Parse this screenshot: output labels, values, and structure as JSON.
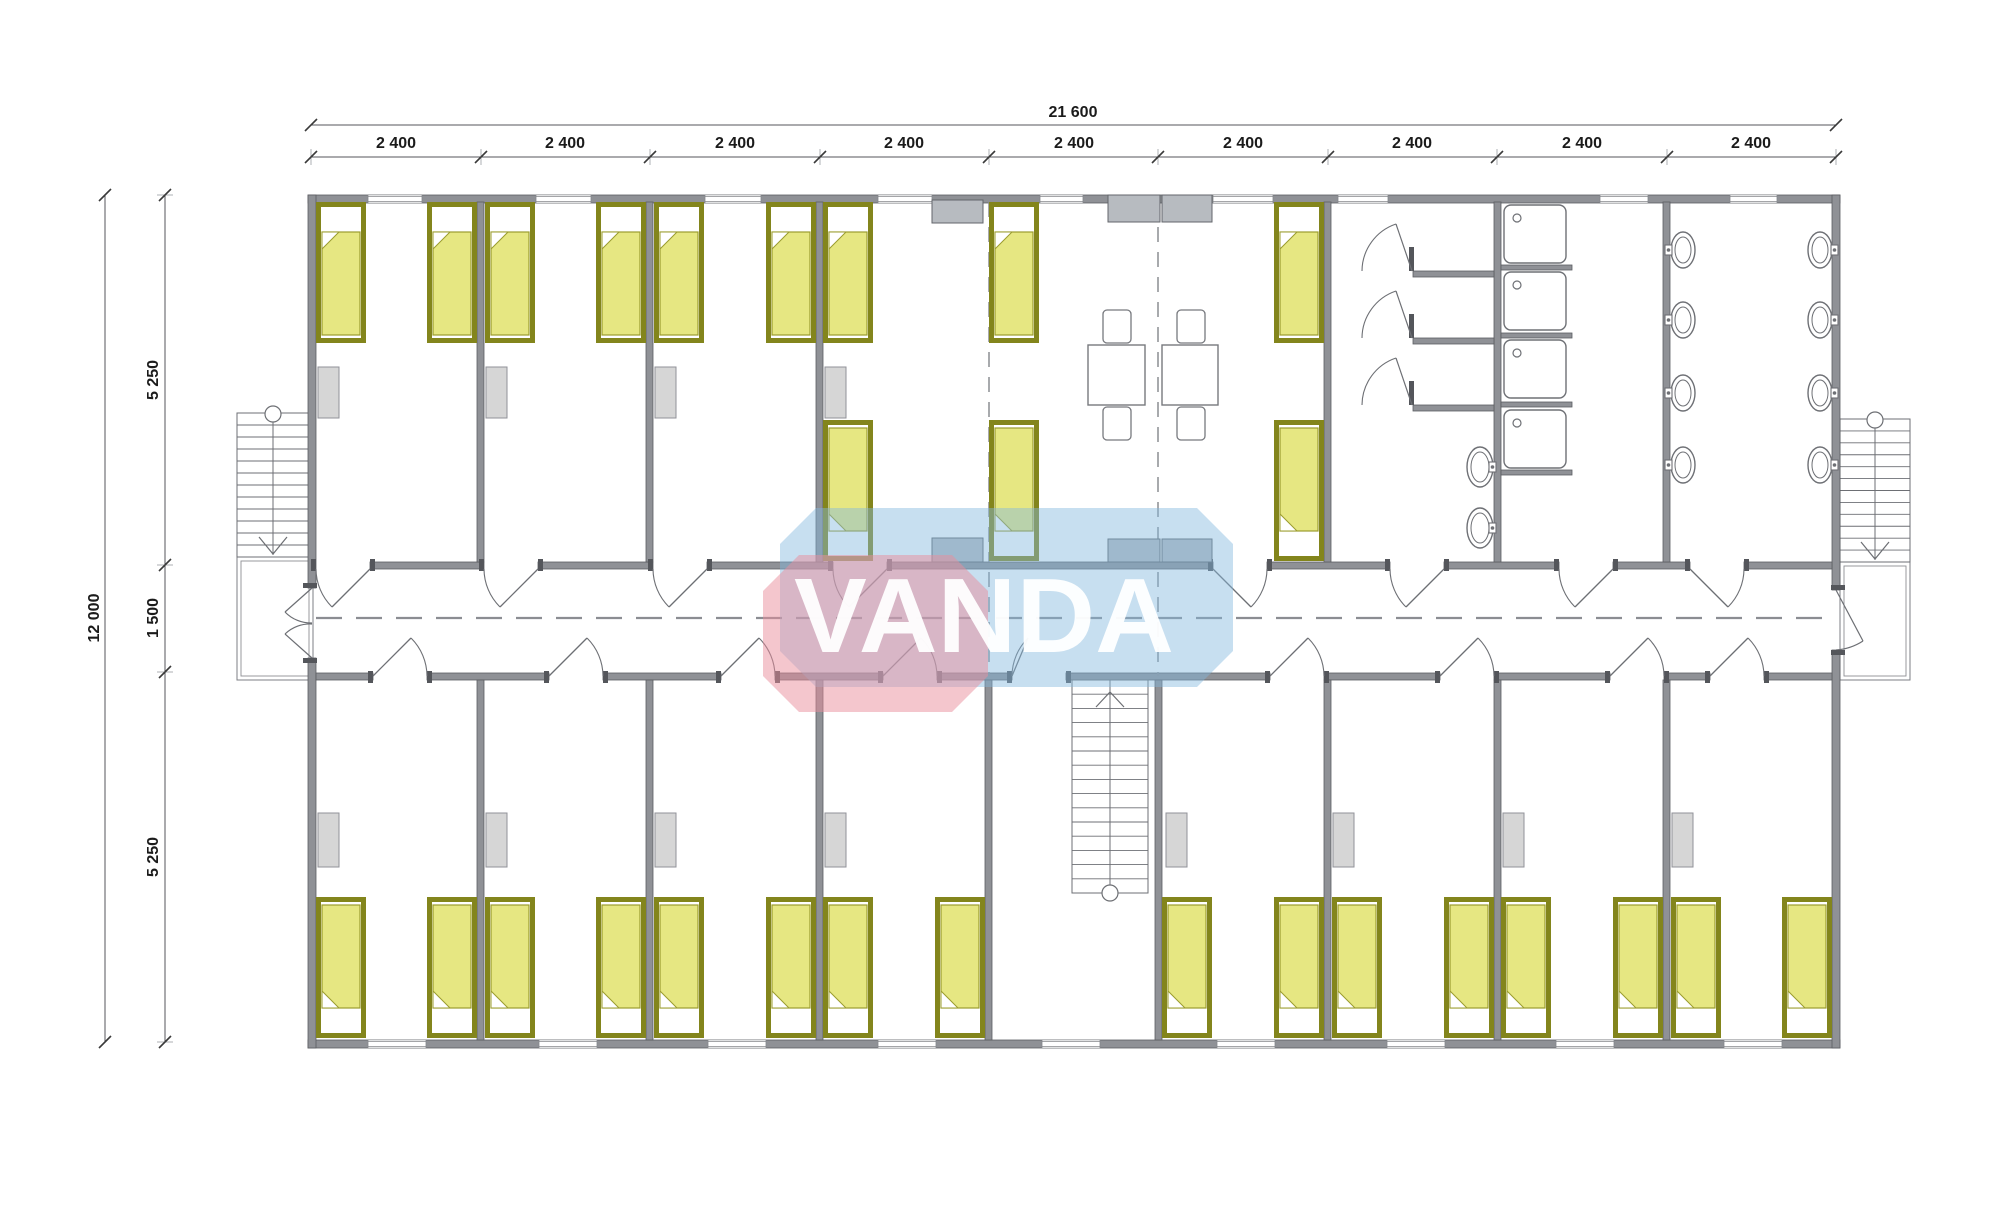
{
  "title": "VANDA modular dormitory floor plan",
  "dimensions": {
    "total_width_label": "21 600",
    "bay_label": "2 400",
    "bay_count": 9,
    "total_height_label": "12 000",
    "height_segment_labels": [
      "5 250",
      "1 500",
      "5 250"
    ]
  },
  "logo": {
    "text": "VANDA",
    "pink": "#ea8e9c",
    "blue": "#83b7de",
    "pink_opacity": 0.5,
    "blue_opacity": 0.45,
    "text_fill": "rgba(255,255,255,0.95)",
    "blue_pts": "816,508 1197,508 1233,544 1233,651 1197,687 816,687 780,651 780,544",
    "pink_pts": "799,555 952,555 988,591 988,676 952,712 799,712 763,676 763,591",
    "tx": 984,
    "ty": 652,
    "size": 106,
    "text_length": 380
  },
  "colors": {
    "wall": "#8f9196",
    "wall_stroke": "#5b5d62",
    "jamb": "#54565b",
    "line": "#6d6f74",
    "thin": "#9a9ca1",
    "dim_line": "#54565b",
    "tick": "#3a3a3a",
    "bed_frame": "#83851c",
    "bed_fill": "#ffffff",
    "blanket": "#e6e782",
    "blanket_line": "#9b9c2e",
    "furn_light": "#d6d6d6",
    "furn_light_stroke": "#909298",
    "counter": "#b7bbc0",
    "counter_stroke": "#63666b",
    "fixture": "#6e7075",
    "dash": "#8b8d92",
    "window_line": "#85878c"
  },
  "plan": {
    "canvas": {
      "w": 2000,
      "h": 1219
    },
    "walls": [
      [
        308,
        195,
        1532,
        8
      ],
      [
        308,
        1040,
        1532,
        8
      ],
      [
        308,
        195,
        8,
        393
      ],
      [
        308,
        658,
        8,
        390
      ],
      [
        1832,
        195,
        8,
        395
      ],
      [
        1832,
        650,
        8,
        398
      ],
      [
        370,
        562,
        114,
        7
      ],
      [
        538,
        562,
        115,
        7
      ],
      [
        707,
        562,
        126,
        7
      ],
      [
        887,
        562,
        326,
        7
      ],
      [
        1267,
        562,
        123,
        7
      ],
      [
        1444,
        562,
        115,
        7
      ],
      [
        1613,
        562,
        77,
        7
      ],
      [
        1744,
        562,
        88,
        7
      ],
      [
        316,
        673,
        57,
        7
      ],
      [
        427,
        673,
        122,
        7
      ],
      [
        603,
        673,
        118,
        7
      ],
      [
        775,
        673,
        108,
        7
      ],
      [
        937,
        673,
        75,
        7
      ],
      [
        1066,
        673,
        204,
        7
      ],
      [
        1324,
        673,
        116,
        7
      ],
      [
        1494,
        673,
        116,
        7
      ],
      [
        1664,
        673,
        46,
        7
      ],
      [
        1764,
        673,
        68,
        7
      ],
      [
        477,
        202,
        7,
        360
      ],
      [
        646,
        202,
        7,
        360
      ],
      [
        816,
        202,
        7,
        360
      ],
      [
        1324,
        202,
        7,
        360
      ],
      [
        1494,
        202,
        7,
        360
      ],
      [
        1663,
        202,
        7,
        360
      ],
      [
        477,
        680,
        7,
        360
      ],
      [
        646,
        680,
        7,
        360
      ],
      [
        816,
        680,
        7,
        360
      ],
      [
        985,
        680,
        7,
        360
      ],
      [
        1155,
        680,
        7,
        360
      ],
      [
        1324,
        680,
        7,
        360
      ],
      [
        1494,
        680,
        7,
        360
      ],
      [
        1663,
        680,
        7,
        360
      ],
      [
        1413,
        271,
        81,
        6
      ],
      [
        1413,
        338,
        81,
        6
      ],
      [
        1413,
        405,
        81,
        6
      ],
      [
        1501,
        265,
        71,
        5
      ],
      [
        1501,
        333,
        71,
        5
      ],
      [
        1501,
        402,
        71,
        5
      ],
      [
        1501,
        470,
        71,
        5
      ]
    ],
    "windows": {
      "top": [
        [
          368,
          54
        ],
        [
          536,
          55
        ],
        [
          705,
          56
        ],
        [
          878,
          54
        ],
        [
          1040,
          43
        ],
        [
          1213,
          60
        ],
        [
          1338,
          50
        ],
        [
          1600,
          48
        ],
        [
          1730,
          47
        ]
      ],
      "bottom": [
        [
          368,
          58
        ],
        [
          539,
          58
        ],
        [
          708,
          58
        ],
        [
          878,
          58
        ],
        [
          1042,
          58
        ],
        [
          1217,
          58
        ],
        [
          1387,
          58
        ],
        [
          1556,
          58
        ],
        [
          1724,
          58
        ]
      ]
    },
    "doors": {
      "upper": [
        [
          316,
          54,
          "r"
        ],
        [
          484,
          54,
          "r"
        ],
        [
          653,
          54,
          "r"
        ],
        [
          833,
          54,
          "r"
        ],
        [
          1213,
          54,
          "l"
        ],
        [
          1390,
          54,
          "r"
        ],
        [
          1559,
          54,
          "r"
        ],
        [
          1690,
          54,
          "l"
        ]
      ],
      "lower": [
        [
          373,
          54,
          "l"
        ],
        [
          549,
          54,
          "l"
        ],
        [
          721,
          54,
          "l"
        ],
        [
          883,
          54,
          "l"
        ],
        [
          1012,
          54,
          "r"
        ],
        [
          1270,
          54,
          "l"
        ],
        [
          1440,
          54,
          "l"
        ],
        [
          1610,
          54,
          "l"
        ],
        [
          1710,
          54,
          "l"
        ]
      ],
      "end_paths": [
        "M312,588 L285,612",
        "M285,612 A36,36 0 0 0 312,623",
        "M312,658 L285,634",
        "M285,634 A36,36 0 0 1 312,624",
        "M1836,590 L1863,641",
        "M1836,650 A57,57 0 0 0 1863,641"
      ],
      "end_jambs": [
        [
          303,
          583,
          14,
          5
        ],
        [
          303,
          658,
          14,
          5
        ],
        [
          1831,
          585,
          14,
          5
        ],
        [
          1831,
          650,
          14,
          5
        ]
      ]
    },
    "dashes": [
      [
        316,
        618,
        1832,
        618,
        "26 14",
        2.2
      ],
      [
        989,
        202,
        989,
        562,
        "15 10",
        1.5
      ],
      [
        989,
        572,
        989,
        676,
        "15 10",
        1.5
      ],
      [
        1158,
        202,
        1158,
        562,
        "15 10",
        1.5
      ],
      [
        1158,
        572,
        1158,
        676,
        "15 10",
        1.5
      ]
    ],
    "beds": {
      "w": 50,
      "h": 141,
      "n": [
        [
          316,
          202
        ],
        [
          427,
          202
        ],
        [
          485,
          202
        ],
        [
          596,
          202
        ],
        [
          654,
          202
        ],
        [
          766,
          202
        ],
        [
          823,
          202
        ],
        [
          989,
          202
        ],
        [
          1274,
          202
        ]
      ],
      "s": [
        [
          823,
          420
        ],
        [
          989,
          420
        ],
        [
          1274,
          420
        ],
        [
          316,
          897
        ],
        [
          427,
          897
        ],
        [
          485,
          897
        ],
        [
          596,
          897
        ],
        [
          654,
          897
        ],
        [
          766,
          897
        ],
        [
          823,
          897
        ],
        [
          935,
          897
        ],
        [
          1162,
          897
        ],
        [
          1274,
          897
        ],
        [
          1332,
          897
        ],
        [
          1444,
          897
        ],
        [
          1501,
          897
        ],
        [
          1613,
          897
        ],
        [
          1671,
          897
        ],
        [
          1782,
          897
        ]
      ]
    },
    "wardrobes": [
      [
        318,
        367,
        21,
        51
      ],
      [
        486,
        367,
        21,
        51
      ],
      [
        655,
        367,
        21,
        51
      ],
      [
        825,
        367,
        21,
        51
      ],
      [
        318,
        813,
        21,
        54
      ],
      [
        486,
        813,
        21,
        54
      ],
      [
        655,
        813,
        21,
        54
      ],
      [
        825,
        813,
        21,
        54
      ],
      [
        1166,
        813,
        21,
        54
      ],
      [
        1333,
        813,
        21,
        54
      ],
      [
        1503,
        813,
        21,
        54
      ],
      [
        1672,
        813,
        21,
        54
      ]
    ],
    "counters": [
      [
        932,
        200,
        51,
        23
      ],
      [
        1108,
        195,
        52,
        27
      ],
      [
        1162,
        195,
        50,
        27
      ],
      [
        932,
        538,
        51,
        24
      ],
      [
        1108,
        539,
        52,
        23
      ],
      [
        1162,
        539,
        50,
        23
      ]
    ],
    "tables": [
      [
        1088,
        345,
        57,
        60
      ],
      [
        1162,
        345,
        56,
        60
      ]
    ],
    "chairs": [
      [
        1103,
        310,
        28,
        33
      ],
      [
        1177,
        310,
        28,
        33
      ],
      [
        1103,
        407,
        28,
        33
      ],
      [
        1177,
        407,
        28,
        33
      ]
    ],
    "sinks": {
      "size": [
        62,
        58
      ],
      "pos": [
        [
          1504,
          205
        ],
        [
          1504,
          272
        ],
        [
          1504,
          340
        ],
        [
          1504,
          410
        ]
      ]
    },
    "wcs": [
      [
        1480,
        467
      ],
      [
        1480,
        528
      ]
    ],
    "basins": {
      "left": [
        [
          1683,
          250
        ],
        [
          1683,
          320
        ],
        [
          1683,
          393
        ],
        [
          1683,
          465
        ]
      ],
      "right": [
        [
          1820,
          250
        ],
        [
          1820,
          320
        ],
        [
          1820,
          393
        ],
        [
          1820,
          465
        ]
      ]
    },
    "cubicles": {
      "pivots": [
        [
          1412,
          271
        ],
        [
          1412,
          338
        ],
        [
          1412,
          405
        ]
      ],
      "stubs": [
        [
          1409,
          247,
          5,
          24
        ],
        [
          1409,
          314,
          5,
          24
        ],
        [
          1409,
          381,
          5,
          24
        ]
      ]
    },
    "stairs": {
      "ext": [
        {
          "x": 237,
          "y": 413,
          "w": 73,
          "h": 144,
          "cx": 273,
          "cy": 414,
          "treads": 12
        },
        {
          "x": 1840,
          "y": 419,
          "w": 70,
          "h": 143,
          "cx": 1875,
          "cy": 420,
          "treads": 12
        }
      ],
      "internal": {
        "x": 1072,
        "y": 680,
        "w": 76,
        "h": 213,
        "cx": 1110,
        "cy": 893,
        "treads": 15
      },
      "landings": [
        [
          237,
          557,
          76,
          123
        ],
        [
          1840,
          562,
          70,
          118
        ]
      ]
    },
    "dims": {
      "top_total": {
        "y": 125,
        "x1": 311,
        "x2": 1836
      },
      "top_bays": {
        "y": 157,
        "ticks": [
          311,
          481,
          650,
          820,
          989,
          1158,
          1328,
          1497,
          1667,
          1836
        ],
        "centers": [
          396,
          565,
          735,
          904,
          1074,
          1243,
          1412,
          1582,
          1751
        ],
        "label_y": 148
      },
      "left_outer": {
        "x": 105,
        "y1": 195,
        "y2": 1042
      },
      "left_inner": {
        "x": 165,
        "ticks": [
          195,
          565,
          672,
          1042
        ]
      }
    }
  }
}
